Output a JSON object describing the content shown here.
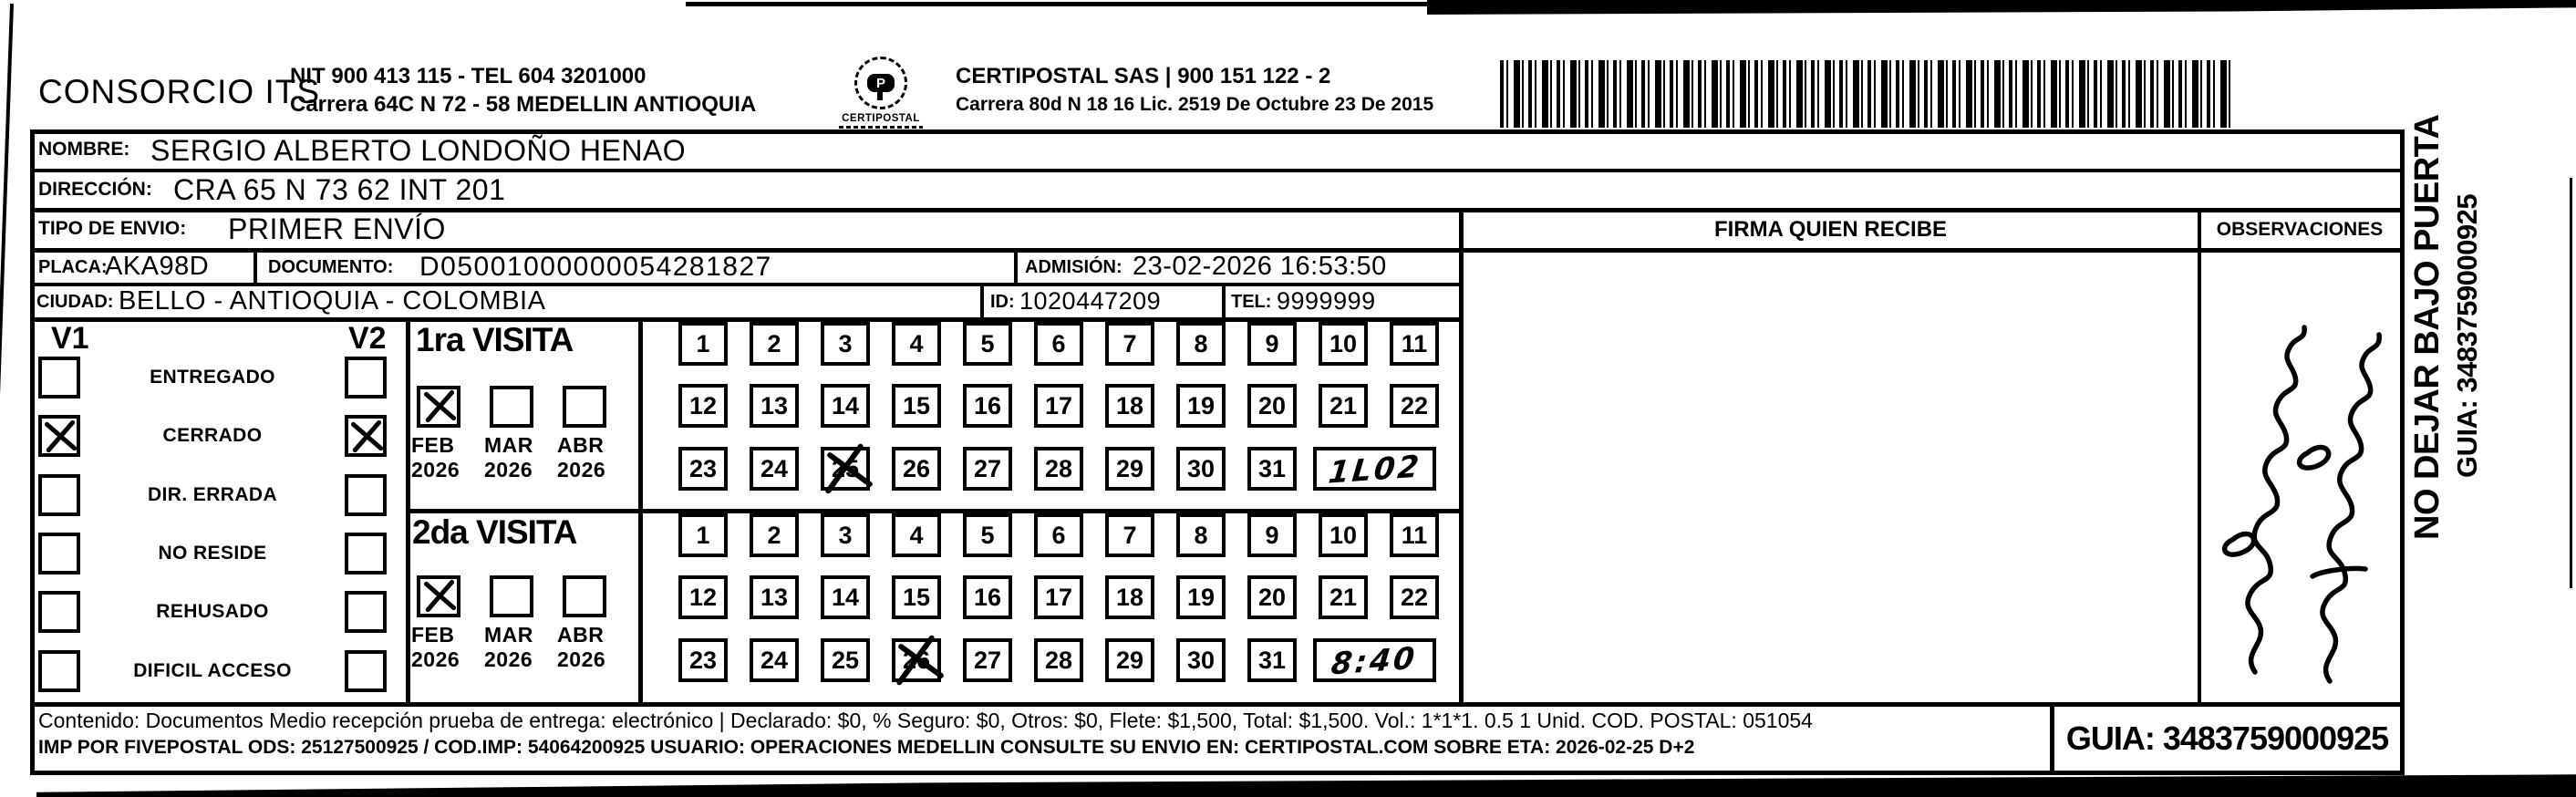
{
  "header": {
    "company_name": "CONSORCIO ITS",
    "nit_tel": "NIT 900 413 115 - TEL 604 3201000",
    "address": "Carrera 64C N 72 - 58 MEDELLIN ANTIOQUIA",
    "logo_text": "CERTIPOSTAL",
    "partner_name": "CERTIPOSTAL SAS | 900 151 122 - 2",
    "partner_info": "Carrera 80d N 18 16  Lic. 2519 De Octubre 23 De 2015"
  },
  "shipment": {
    "nombre_label": "NOMBRE:",
    "nombre": "SERGIO ALBERTO LONDOÑO HENAO",
    "direccion_label": "DIRECCIÓN:",
    "direccion": "CRA 65 N 73 62 INT 201",
    "tipo_envio_label": "TIPO DE ENVIO:",
    "tipo_envio": "PRIMER ENVÍO",
    "placa_label": "PLACA:",
    "placa": "AKA98D",
    "documento_label": "DOCUMENTO:",
    "documento": "D05001000000054281827",
    "admision_label": "ADMISIÓN:",
    "admision": "23-02-2026 16:53:50",
    "ciudad_label": "CIUDAD:",
    "ciudad": "BELLO - ANTIOQUIA - COLOMBIA",
    "id_label": "ID:",
    "id_value": "1020447209",
    "tel_label": "TEL:",
    "tel": "9999999"
  },
  "status_panel": {
    "v1_label": "V1",
    "v2_label": "V2",
    "rows": [
      {
        "label": "ENTREGADO",
        "v1": false,
        "v2": false
      },
      {
        "label": "CERRADO",
        "v1": true,
        "v2": true
      },
      {
        "label": "DIR. ERRADA",
        "v1": false,
        "v2": false
      },
      {
        "label": "NO RESIDE",
        "v1": false,
        "v2": false
      },
      {
        "label": "REHUSADO",
        "v1": false,
        "v2": false
      },
      {
        "label": "DIFICIL ACCESO",
        "v1": false,
        "v2": false
      }
    ]
  },
  "visits": [
    {
      "title": "1ra VISITA",
      "months": [
        {
          "label": "FEB",
          "year": "2026",
          "checked": true
        },
        {
          "label": "MAR",
          "year": "2026",
          "checked": false
        },
        {
          "label": "ABR",
          "year": "2026",
          "checked": false
        }
      ],
      "crossed_day": 25,
      "time_note": "1L02"
    },
    {
      "title": "2da VISITA",
      "months": [
        {
          "label": "FEB",
          "year": "2026",
          "checked": true
        },
        {
          "label": "MAR",
          "year": "2026",
          "checked": false
        },
        {
          "label": "ABR",
          "year": "2026",
          "checked": false
        }
      ],
      "crossed_day": 26,
      "time_note": "8:40"
    }
  ],
  "day_rows": [
    [
      1,
      2,
      3,
      4,
      5,
      6,
      7,
      8,
      9,
      10,
      11
    ],
    [
      12,
      13,
      14,
      15,
      16,
      17,
      18,
      19,
      20,
      21,
      22
    ],
    [
      23,
      24,
      25,
      26,
      27,
      28,
      29,
      30,
      31
    ]
  ],
  "receipt": {
    "firma_header": "FIRMA QUIEN RECIBE",
    "observaciones_header": "OBSERVACIONES",
    "observaciones_note": "handwritten note, illegible, 2 rotated lines"
  },
  "side_note": {
    "warning": "NO DEJAR BAJO PUERTA",
    "guia": "GUIA: 3483759000925"
  },
  "footer": {
    "line1": "Contenido: Documentos Medio recepción prueba de entrega: electrónico | Declarado: $0, % Seguro: $0, Otros: $0, Flete: $1,500, Total: $1,500. Vol.: 1*1*1. 0.5  1 Unid. COD. POSTAL: 051054",
    "line2": "IMP POR FIVEPOSTAL ODS: 25127500925 / COD.IMP: 54064200925 USUARIO: OPERACIONES MEDELLIN CONSULTE SU ENVIO EN: CERTIPOSTAL.COM SOBRE ETA: 2026-02-25 D+2",
    "guia_box": "GUIA: 3483759000925"
  }
}
